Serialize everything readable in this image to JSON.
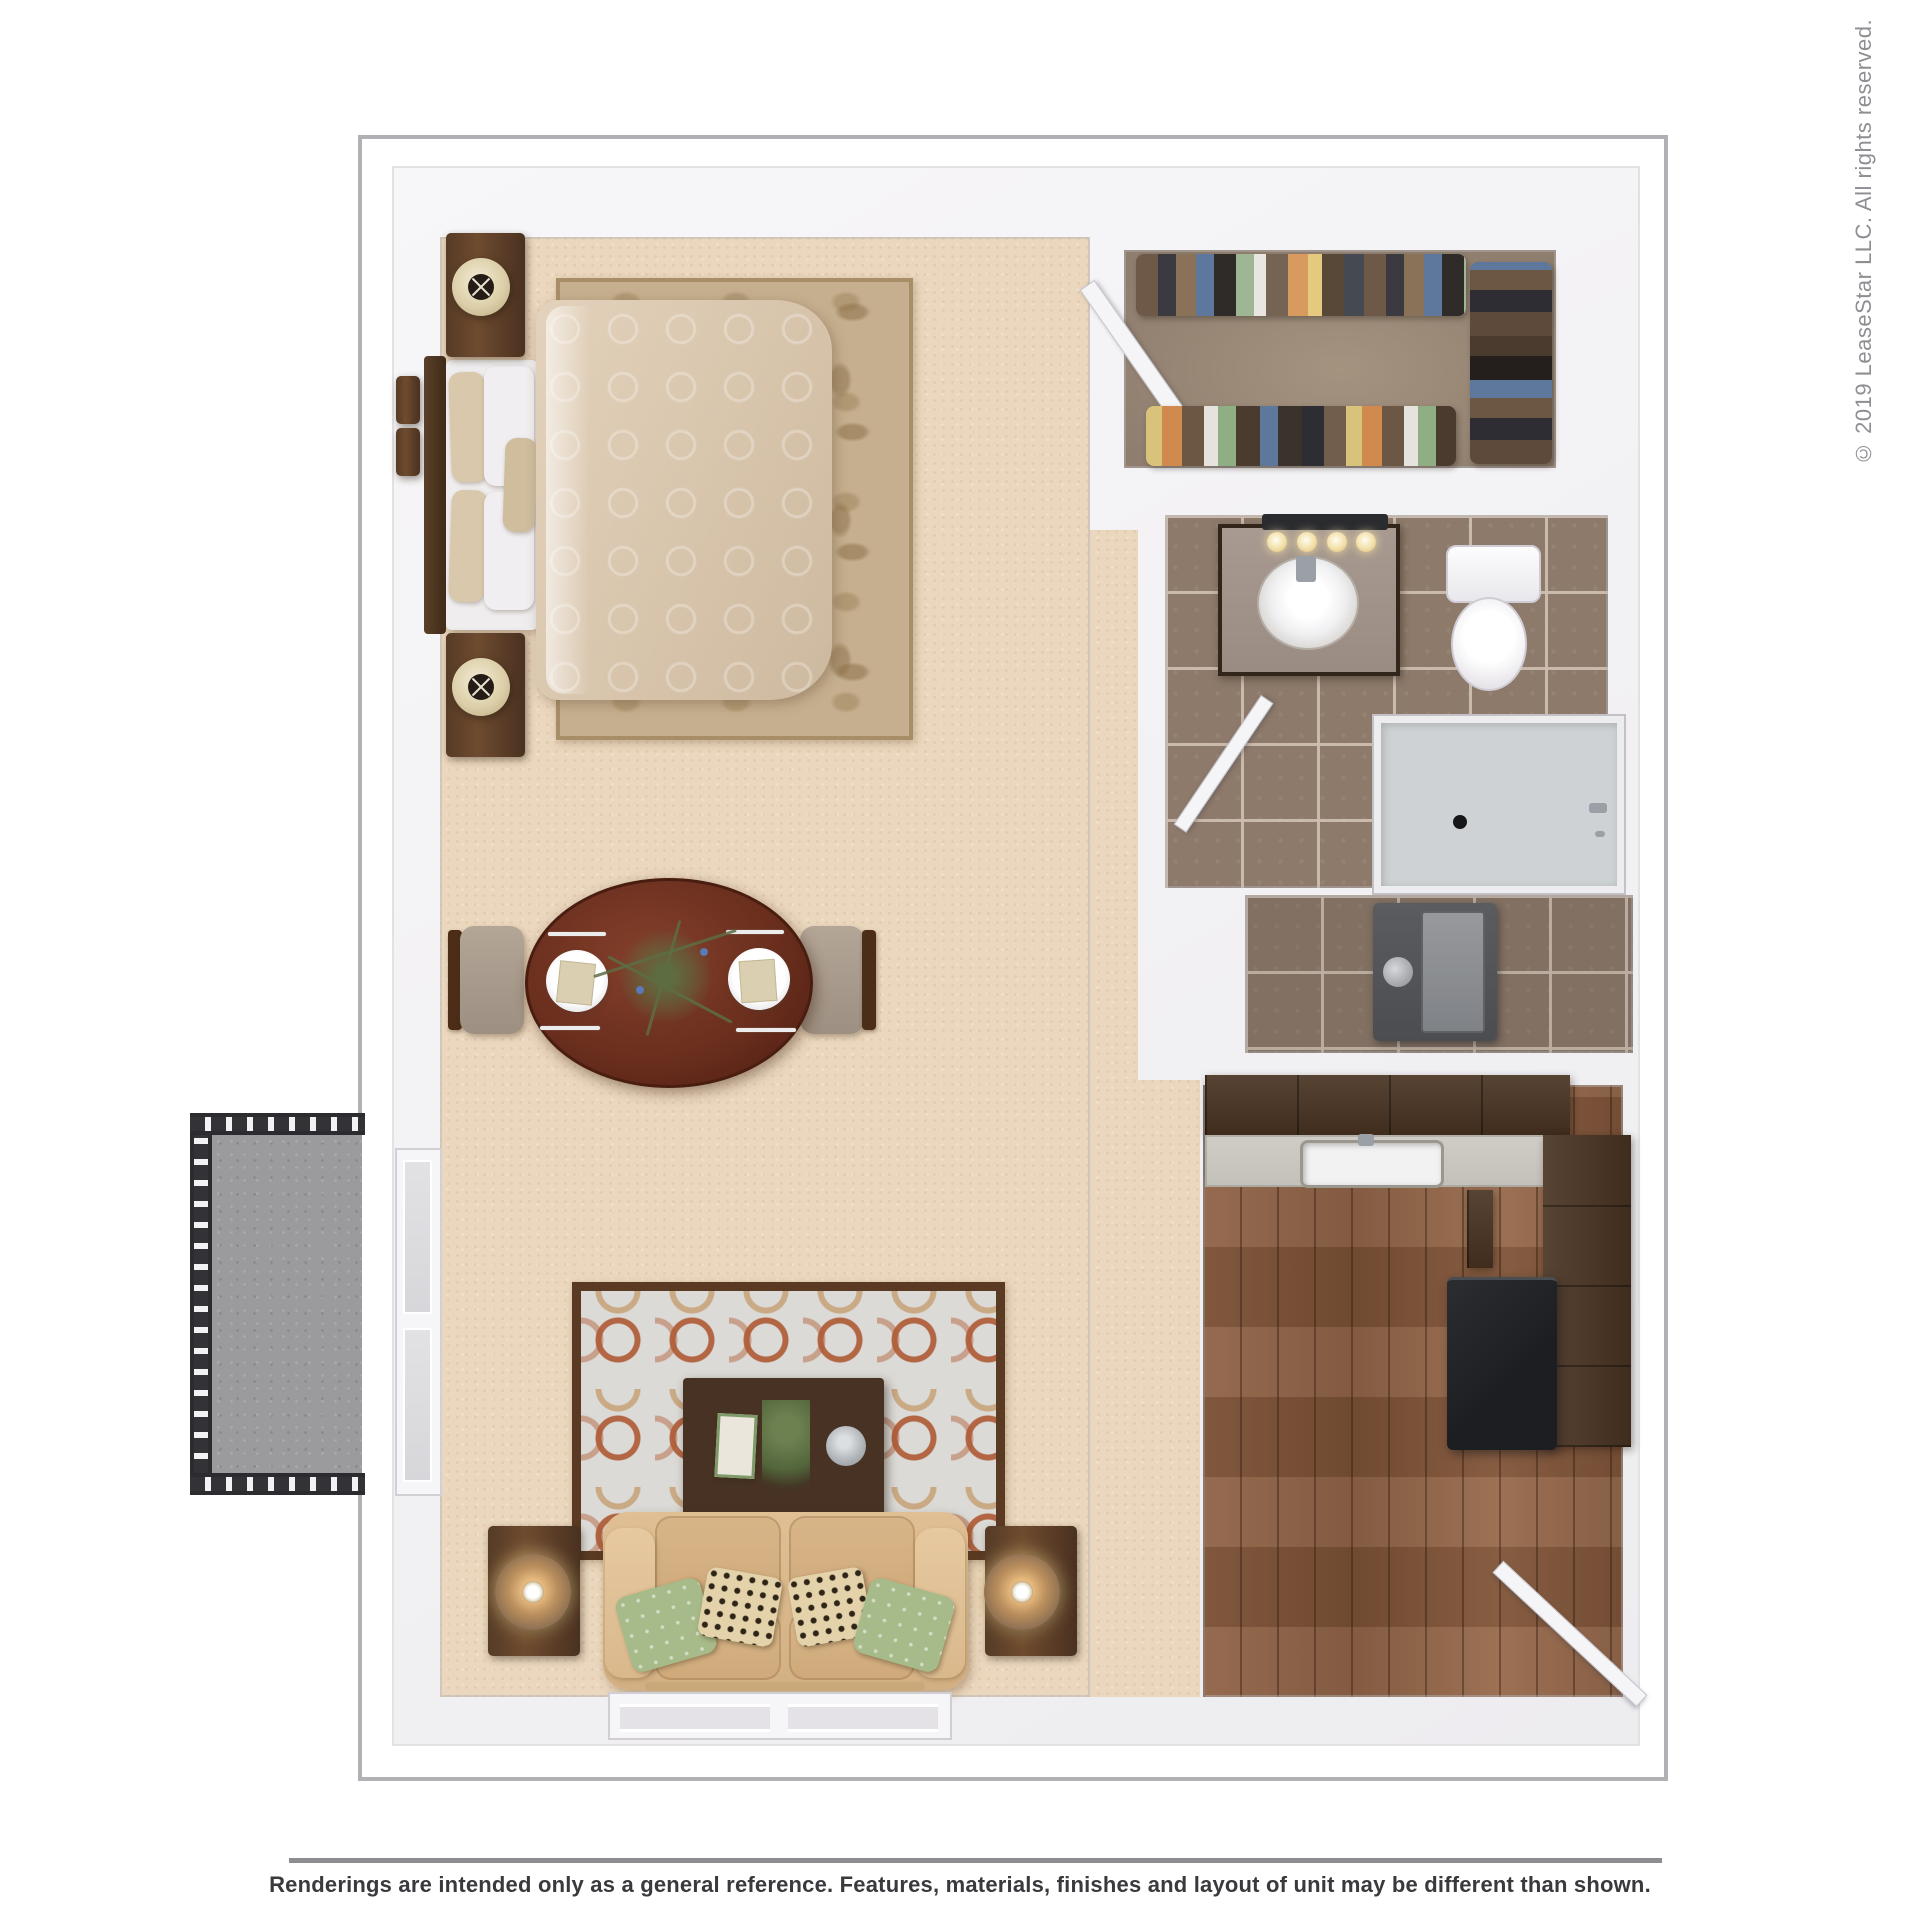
{
  "watermark": {
    "text": "© 2019 LeaseStar LLC. All rights reserved.",
    "color": "#8f8e93"
  },
  "footer": {
    "disclaimer": "Renderings are intended only as a general reference. Features, materials, finishes and layout of unit may be different than shown.",
    "divider_color": "#8d8c91",
    "text_color": "#3a3a3e"
  },
  "plan": {
    "frame_border_color": "#b2afb5",
    "wall_color": "#f4f3f5",
    "rooms": [
      {
        "name": "main-living-bedroom",
        "floor": "carpet",
        "floor_color": "#ebd7bd"
      },
      {
        "name": "walk-in-closet",
        "floor": "vinyl",
        "floor_color": "#9c8c7d"
      },
      {
        "name": "bathroom",
        "floor": "tile",
        "floor_color": "#8d7a6b"
      },
      {
        "name": "utility-closet",
        "floor": "tile",
        "floor_color": "#84715f"
      },
      {
        "name": "kitchen",
        "floor": "wood",
        "floor_color": "#8a5d41"
      },
      {
        "name": "balcony",
        "floor": "concrete",
        "floor_color": "#9b9a9c",
        "railing_color": "#323237"
      }
    ],
    "furniture_colors": {
      "dark_wood": "#47311f",
      "dining_table": "#6b2f1e",
      "sofa": "#dcba8e",
      "pillow_green": "#a7ba89",
      "pillow_leopard": "#e4d3aa",
      "bed_comforter": "#dccab3",
      "bedroom_rug": "#c5af8e",
      "living_rug_field": "#dcdad6",
      "living_rug_accent": "#ae5a34",
      "cabinets": "#4a3422",
      "refrigerator": "#232528",
      "water_heater": "#56585c"
    }
  }
}
